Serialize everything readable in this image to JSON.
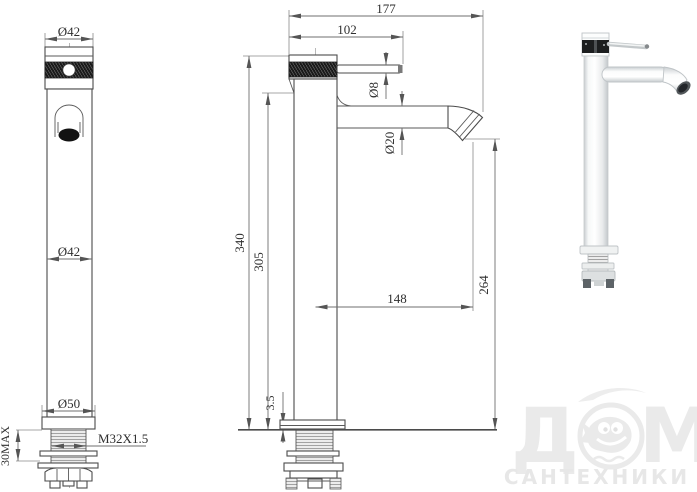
{
  "front_view": {
    "dim_head_diameter": "Ø42",
    "dim_body_diameter": "Ø42",
    "dim_base_diameter": "Ø50",
    "dim_mounting_thickness": "30MAX",
    "dim_thread_spec": "M32X1.5"
  },
  "side_view": {
    "dim_overall_depth": "177",
    "dim_body_to_handle_tip": "102",
    "dim_handle_rod_diameter": "Ø8",
    "dim_spout_tube_diameter": "Ø20",
    "dim_overall_height": "340",
    "dim_body_height": "305",
    "dim_spout_reach": "148",
    "dim_spout_outlet_height": "264",
    "dim_base_plate_thickness": "3.5"
  },
  "watermark": {
    "brand_first_letter": "Д",
    "brand_last_letter": "М",
    "brand_subtitle": "САНТЕХНИКИ"
  },
  "colors": {
    "outline": "#4b4b4b",
    "dimension_line": "#6f6f6f",
    "dimension_text": "#2f2f2f",
    "knurl_dark": "#1a1a1a",
    "watermark_gray": "#eaeaea",
    "background": "#ffffff"
  }
}
